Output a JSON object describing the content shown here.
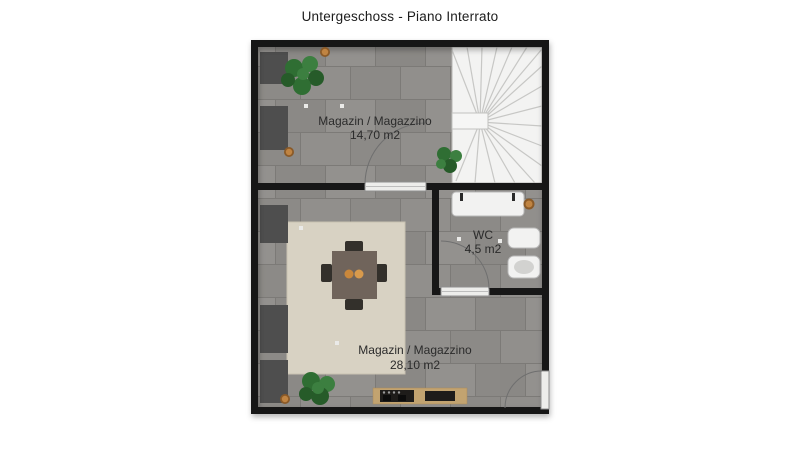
{
  "title": "Untergeschoss - Piano Interrato",
  "floor_plan": {
    "rooms": [
      {
        "id": "storage-upper",
        "name": "Magazin / Magazzino",
        "area": "14,70 m2"
      },
      {
        "id": "wc",
        "name": "WC",
        "area": "4,5 m2"
      },
      {
        "id": "storage-lower",
        "name": "Magazin / Magazzino",
        "area": "28,10 m2"
      }
    ],
    "features": [
      "winder-staircase",
      "dining-table-with-chairs",
      "rug",
      "kitchen-counter",
      "wall-shelves",
      "plants",
      "wc-sink",
      "wc-toilet",
      "wc-bidet",
      "three-doors"
    ],
    "colors": {
      "wall": "#171717",
      "floor": "#8f8d8a",
      "grout": "#7c7a77",
      "stairs": "#f3f3f2",
      "rug": "#d8d2c3",
      "table": "#70645b",
      "chair": "#33302b",
      "shelf": "#4e4e4e",
      "counter": "#c2a370",
      "fixture": "#f2f2f1",
      "plant": "#2f6e33",
      "pot": "#b87a33",
      "text": "#2b2b2b",
      "background": "#ffffff"
    }
  }
}
